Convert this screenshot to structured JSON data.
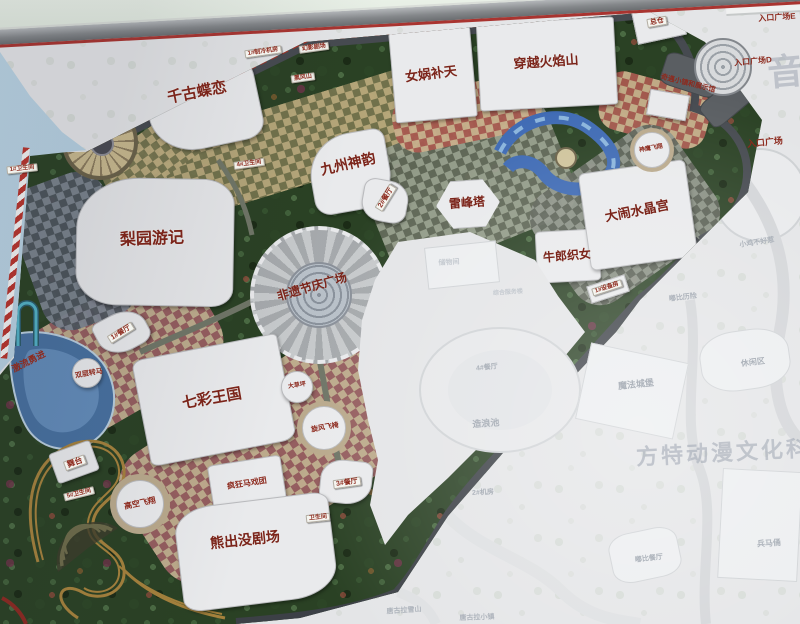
{
  "scene": {
    "description": "Photographed masterplan signboard of a Fantawild theme park; right and lower-right portions of the sign are sun-faded",
    "watermark_text": "方特动漫文化科技",
    "partial_watermark_char": "音"
  },
  "colors": {
    "forest": "#2a4124",
    "checker_tan": "#bcab7e",
    "checker_olive": "#75744e",
    "checker_maroon": "#9a5f62",
    "checker_sand": "#c4b091",
    "water": "#47709f",
    "road_dark": "#3c4046",
    "accent_red": "#a23226",
    "label_red": "#7b241a",
    "faded_bg": "#e4e5e7",
    "faded_text": "#aeb4bc",
    "sky": "#a9c6dc"
  },
  "map": {
    "labels": [
      {
        "id": "label-qiangu-dielian",
        "text": "千古蝶恋",
        "x": 197,
        "y": 93,
        "rot": -11,
        "fs": 15,
        "kind": "big"
      },
      {
        "id": "label-nuwa-butian",
        "text": "女娲补天",
        "x": 431,
        "y": 74,
        "rot": -7,
        "fs": 13,
        "kind": "big"
      },
      {
        "id": "label-chuanyue-huoyanshan",
        "text": "穿越火焰山",
        "x": 546,
        "y": 62,
        "rot": -4,
        "fs": 13,
        "kind": "big"
      },
      {
        "id": "label-jiuzhou-shenyun",
        "text": "九州神韵",
        "x": 348,
        "y": 164,
        "rot": -13,
        "fs": 14,
        "kind": "big"
      },
      {
        "id": "label-liyuan-youji",
        "text": "梨园游记",
        "x": 152,
        "y": 240,
        "rot": -2,
        "fs": 16,
        "kind": "big"
      },
      {
        "id": "label-qicai-wangguo",
        "text": "七彩王国",
        "x": 212,
        "y": 399,
        "rot": -10,
        "fs": 15,
        "kind": "big"
      },
      {
        "id": "label-xiongchumo-juchang",
        "text": "熊出没剧场",
        "x": 245,
        "y": 540,
        "rot": -6,
        "fs": 14,
        "kind": "big"
      },
      {
        "id": "label-danao-shuijinggong",
        "text": "大闹水晶宫",
        "x": 637,
        "y": 211,
        "rot": -11,
        "fs": 13,
        "kind": "big"
      },
      {
        "id": "label-niulang-zhinv",
        "text": "牛郎织女",
        "x": 567,
        "y": 256,
        "rot": -5,
        "fs": 12,
        "kind": "big"
      },
      {
        "id": "label-leifengta",
        "text": "雷峰塔",
        "x": 467,
        "y": 203,
        "rot": -4,
        "fs": 12,
        "kind": "big"
      },
      {
        "id": "label-feiyi-jieqing-guangchang",
        "text": "非遗节庆广场",
        "x": 312,
        "y": 287,
        "rot": -16,
        "fs": 12,
        "kind": "big"
      },
      {
        "id": "label-zongcang",
        "text": "总仓",
        "x": 657,
        "y": 22,
        "rot": -10,
        "fs": 7,
        "kind": "box"
      },
      {
        "id": "label-zhilengjifang",
        "text": "1#制冷机房",
        "x": 263,
        "y": 52,
        "rot": -8,
        "fs": 6,
        "kind": "box"
      },
      {
        "id": "label-huanying-juchang",
        "text": "幻影剧场",
        "x": 314,
        "y": 48,
        "rot": -8,
        "fs": 6,
        "kind": "box"
      },
      {
        "id": "label-heifengshan",
        "text": "黑风山",
        "x": 303,
        "y": 78,
        "rot": -8,
        "fs": 6,
        "kind": "box"
      },
      {
        "id": "label-weishengjian-1",
        "text": "1#卫生间",
        "x": 22,
        "y": 169,
        "rot": -6,
        "fs": 6,
        "kind": "box"
      },
      {
        "id": "label-weishengjian-4",
        "text": "4#卫生间",
        "x": 249,
        "y": 164,
        "rot": -8,
        "fs": 6,
        "kind": "box"
      },
      {
        "id": "label-canting-2",
        "text": "2#餐厅",
        "x": 386,
        "y": 198,
        "rot": -58,
        "fs": 7,
        "kind": "box"
      },
      {
        "id": "label-canting-1",
        "text": "1#餐厅",
        "x": 121,
        "y": 333,
        "rot": -32,
        "fs": 7,
        "kind": "box"
      },
      {
        "id": "label-wutai",
        "text": "舞台",
        "x": 75,
        "y": 463,
        "rot": -20,
        "fs": 8,
        "kind": "box"
      },
      {
        "id": "label-canting-3",
        "text": "3#餐厅",
        "x": 347,
        "y": 483,
        "rot": -8,
        "fs": 7,
        "kind": "box"
      },
      {
        "id": "label-weishengjian-5",
        "text": "5#卫生间",
        "x": 79,
        "y": 494,
        "rot": -14,
        "fs": 6,
        "kind": "box"
      },
      {
        "id": "label-weishengjian-6",
        "text": "卫生间",
        "x": 318,
        "y": 518,
        "rot": -6,
        "fs": 6,
        "kind": "box"
      },
      {
        "id": "label-shebeifang",
        "text": "1#设备房",
        "x": 607,
        "y": 288,
        "rot": -18,
        "fs": 6,
        "kind": "box"
      },
      {
        "id": "label-jiliu-yongjin",
        "text": "激流勇进",
        "x": 29,
        "y": 362,
        "rot": -27,
        "fs": 9,
        "kind": "red"
      },
      {
        "id": "label-shuangceng-zhuanma",
        "text": "双层转马",
        "x": 89,
        "y": 374,
        "rot": -10,
        "fs": 7,
        "kind": "red"
      },
      {
        "id": "label-gaokong-feixiang",
        "text": "高空飞翔",
        "x": 140,
        "y": 504,
        "rot": -12,
        "fs": 8,
        "kind": "red"
      },
      {
        "id": "label-fengkuang-maxituan",
        "text": "疯狂马戏团",
        "x": 247,
        "y": 484,
        "rot": -9,
        "fs": 8,
        "kind": "red"
      },
      {
        "id": "label-xuanfeng-feiyi",
        "text": "旋风飞椅",
        "x": 325,
        "y": 428,
        "rot": -10,
        "fs": 7,
        "kind": "red"
      },
      {
        "id": "label-dacaoping",
        "text": "大草坪",
        "x": 297,
        "y": 386,
        "rot": -8,
        "fs": 6,
        "kind": "red"
      },
      {
        "id": "label-shenying-feixiang",
        "text": "神鹰飞翔",
        "x": 651,
        "y": 149,
        "rot": -10,
        "fs": 6,
        "kind": "red"
      },
      {
        "id": "label-qiyu-xiaozhen-zhanshiguan",
        "text": "奇遇小镇和展示馆",
        "x": 688,
        "y": 84,
        "rot": 14,
        "fs": 7,
        "kind": "red"
      },
      {
        "id": "label-rukou-guangchang",
        "text": "入口广场",
        "x": 765,
        "y": 143,
        "rot": -6,
        "fs": 9,
        "kind": "red"
      },
      {
        "id": "label-rukou-guangchang-d",
        "text": "入口广场D",
        "x": 753,
        "y": 62,
        "rot": -5,
        "fs": 8,
        "kind": "red"
      },
      {
        "id": "label-rukou-guangchang-e",
        "text": "入口广场E",
        "x": 777,
        "y": 18,
        "rot": -4,
        "fs": 8,
        "kind": "red"
      },
      {
        "id": "label-canting-4",
        "text": "4#餐厅",
        "x": 487,
        "y": 368,
        "rot": -6,
        "fs": 7,
        "kind": "faded"
      },
      {
        "id": "label-zaolangchi",
        "text": "造浪池",
        "x": 486,
        "y": 424,
        "rot": -4,
        "fs": 9,
        "kind": "faded"
      },
      {
        "id": "label-jifang-2",
        "text": "2#机房",
        "x": 483,
        "y": 493,
        "rot": -3,
        "fs": 7,
        "kind": "faded"
      },
      {
        "id": "label-mofa-chengbao",
        "text": "魔法城堡",
        "x": 636,
        "y": 385,
        "rot": -6,
        "fs": 9,
        "kind": "faded"
      },
      {
        "id": "label-xiuxianqu",
        "text": "休闲区",
        "x": 753,
        "y": 363,
        "rot": -7,
        "fs": 8,
        "kind": "faded"
      },
      {
        "id": "label-bingmayong",
        "text": "兵马俑",
        "x": 769,
        "y": 544,
        "rot": -4,
        "fs": 8,
        "kind": "faded"
      },
      {
        "id": "label-dubi-canting",
        "text": "嘟比餐厅",
        "x": 649,
        "y": 559,
        "rot": -7,
        "fs": 7,
        "kind": "faded"
      },
      {
        "id": "label-tanggula-xueshan",
        "text": "唐古拉雪山",
        "x": 404,
        "y": 611,
        "rot": -4,
        "fs": 7,
        "kind": "faded"
      },
      {
        "id": "label-tanggula-xiaozhen",
        "text": "唐古拉小镇",
        "x": 477,
        "y": 618,
        "rot": -2,
        "fs": 7,
        "kind": "faded"
      },
      {
        "id": "label-xiaoji-buhaore",
        "text": "小鸡不好惹",
        "x": 757,
        "y": 243,
        "rot": -9,
        "fs": 7,
        "kind": "faded"
      },
      {
        "id": "label-dubi-lixian",
        "text": "嘟比历险",
        "x": 683,
        "y": 298,
        "rot": -7,
        "fs": 7,
        "kind": "faded"
      },
      {
        "id": "label-chuwujian",
        "text": "储物间",
        "x": 449,
        "y": 263,
        "rot": -4,
        "fs": 7,
        "kind": "faint"
      },
      {
        "id": "label-zonghe-fuwulou",
        "text": "综合服务楼",
        "x": 508,
        "y": 293,
        "rot": -4,
        "fs": 6,
        "kind": "faint"
      },
      {
        "id": "label-fangte-watermark",
        "text": "方特动漫文化科技",
        "x": 736,
        "y": 452,
        "rot": -3,
        "fs": 22,
        "kind": "wm"
      },
      {
        "id": "label-yin-watermark",
        "text": "音",
        "x": 787,
        "y": 72,
        "rot": -5,
        "fs": 36,
        "kind": "wm"
      }
    ]
  }
}
